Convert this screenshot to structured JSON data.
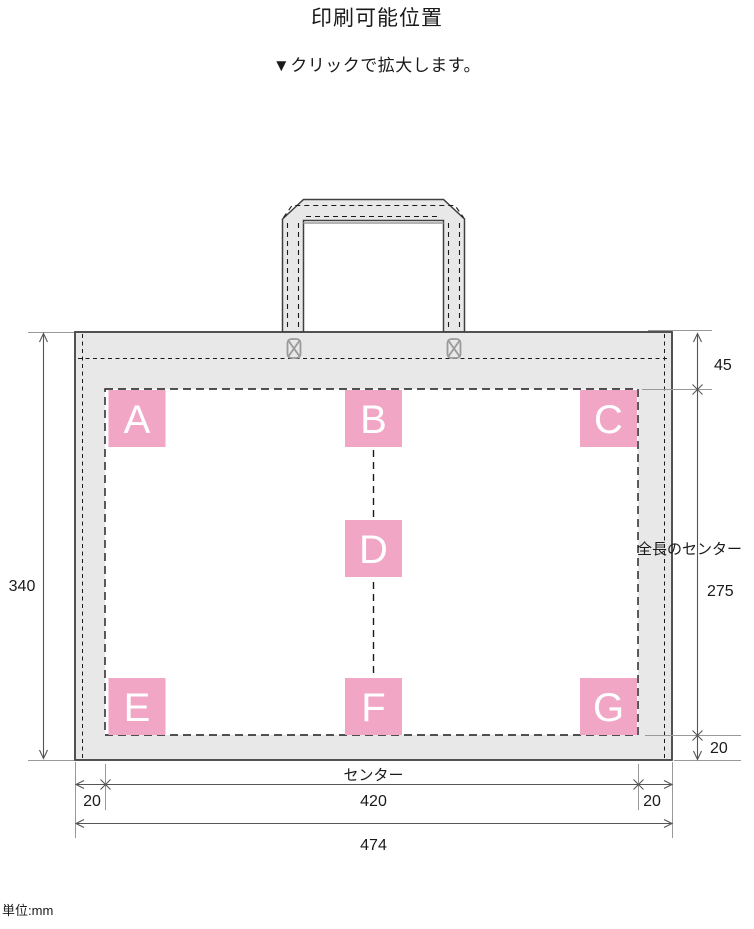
{
  "page": {
    "title": "印刷可能位置",
    "subtitle": "▼クリックで拡大します。",
    "unit_note": "単位:mm"
  },
  "diagram": {
    "positions": [
      {
        "id": "A"
      },
      {
        "id": "B"
      },
      {
        "id": "C"
      },
      {
        "id": "D"
      },
      {
        "id": "E"
      },
      {
        "id": "F"
      },
      {
        "id": "G"
      }
    ],
    "labels": {
      "full_length_center": "全長のセンター",
      "center": "センター"
    },
    "dimensions": {
      "top_to_print_area": "45",
      "bag_height": "340",
      "print_area_height": "275",
      "print_bottom_margin": "20",
      "left_margin": "20",
      "print_area_width": "420",
      "right_margin": "20",
      "bag_width": "474"
    },
    "colors": {
      "position_marker": "#F2A6C6",
      "bag_fill": "#E8E8E8",
      "outline": "#404040"
    }
  }
}
